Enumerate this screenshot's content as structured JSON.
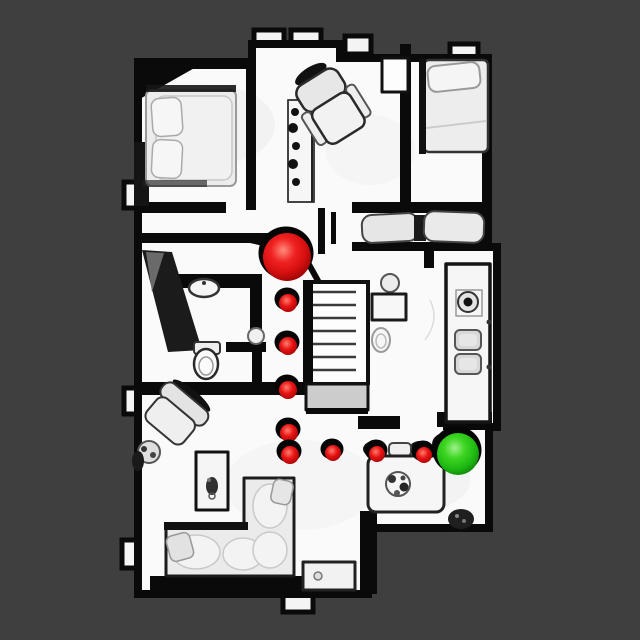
{
  "scene": {
    "description": "top-down 3D mesh scan of a house floor plan with a navigation path",
    "background_color": "#3f3f3f",
    "floor_color": "#fafafa",
    "wall_color": "#0a0a0a",
    "markers": {
      "start": {
        "x": 287,
        "y": 257,
        "r": 24,
        "color": "#e01313",
        "name": "start-sphere"
      },
      "goal": {
        "x": 458,
        "y": 454,
        "r": 21,
        "color": "#28c416",
        "name": "goal-sphere"
      },
      "waypoint_color": "#e01313",
      "waypoints": [
        {
          "x": 288,
          "y": 303,
          "r": 9
        },
        {
          "x": 288,
          "y": 346,
          "r": 9
        },
        {
          "x": 288,
          "y": 390,
          "r": 9
        },
        {
          "x": 289,
          "y": 433,
          "r": 9
        },
        {
          "x": 290,
          "y": 455,
          "r": 9
        },
        {
          "x": 333,
          "y": 453,
          "r": 8
        },
        {
          "x": 377,
          "y": 454,
          "r": 8
        },
        {
          "x": 424,
          "y": 455,
          "r": 8
        }
      ]
    }
  }
}
